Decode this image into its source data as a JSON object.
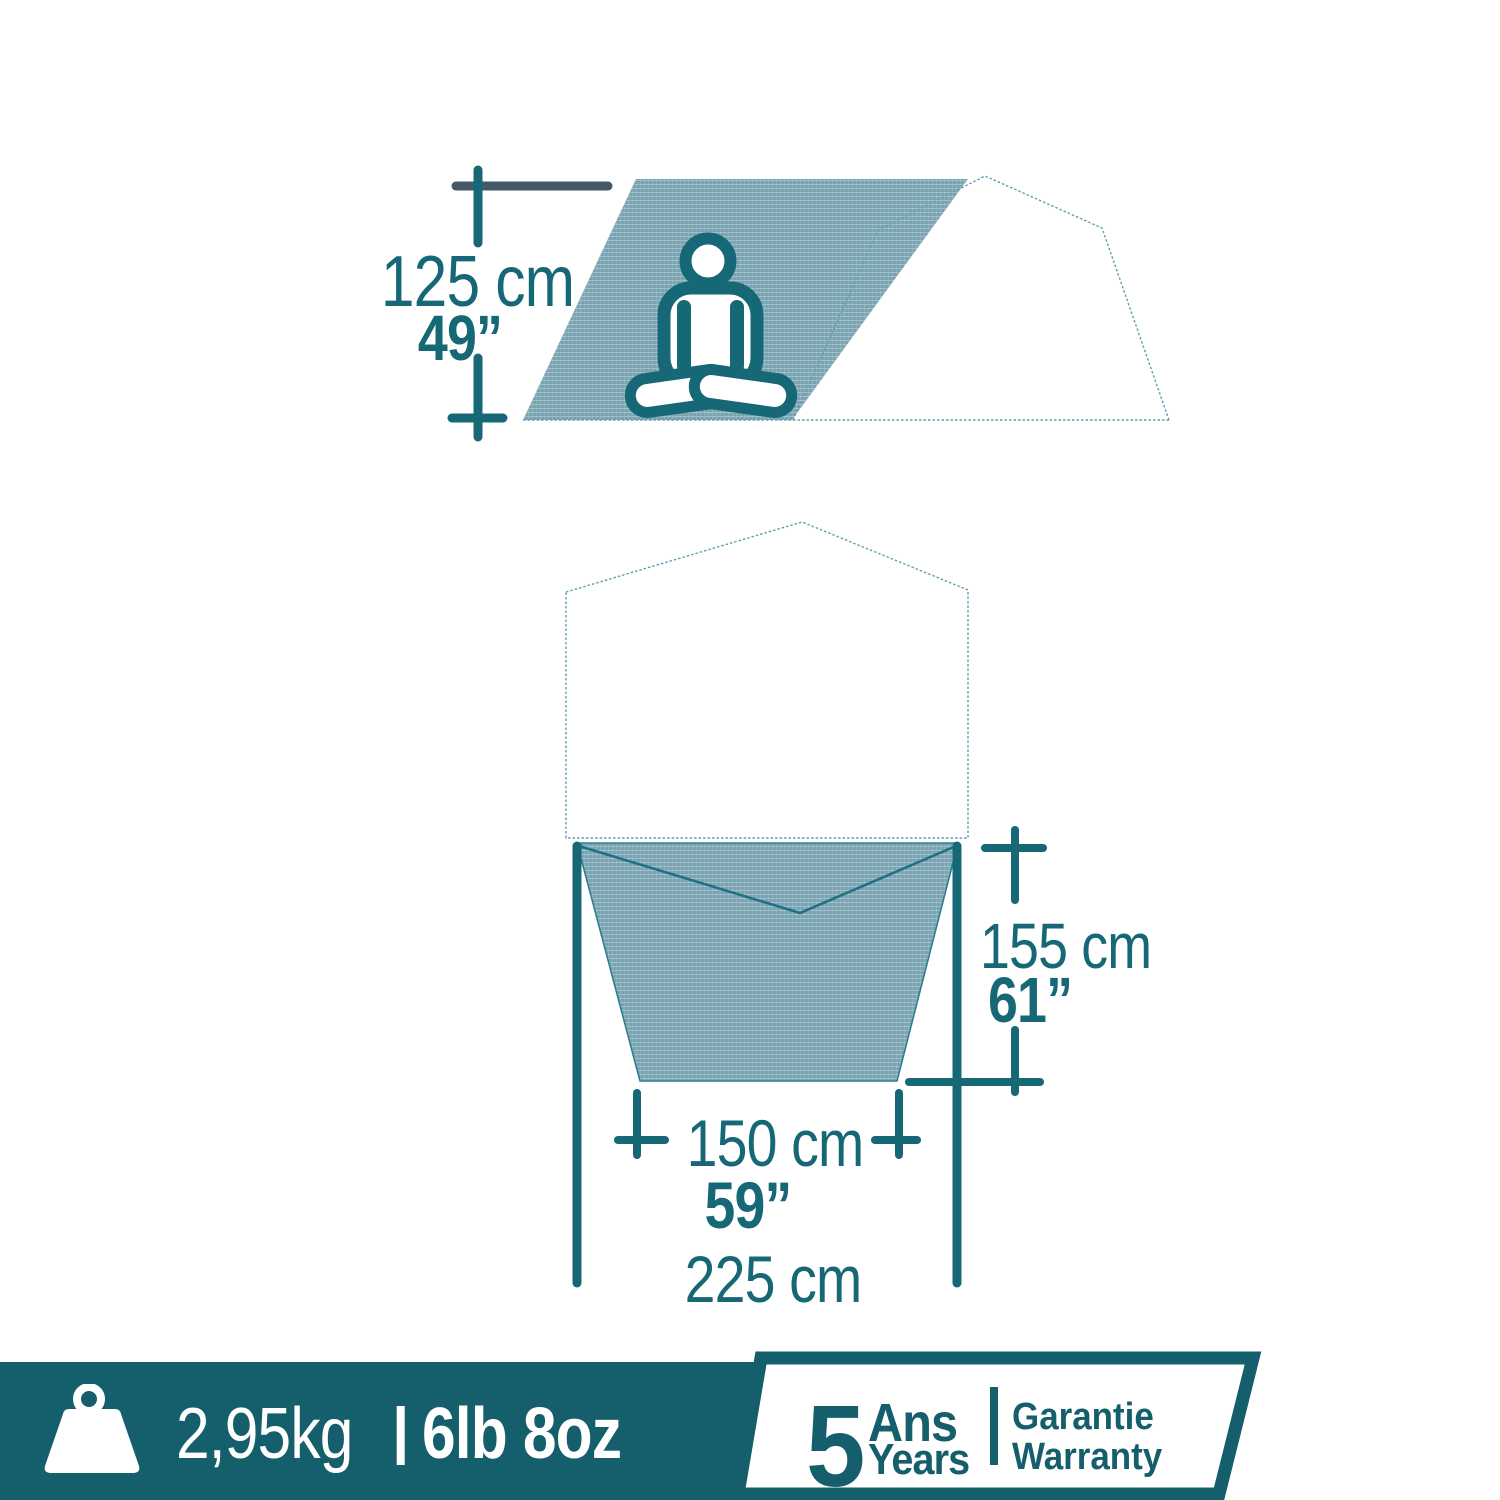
{
  "side_view": {
    "height_cm": "125 cm",
    "height_in": "49”"
  },
  "top_view": {
    "depth_cm": "155 cm",
    "depth_in": "61”",
    "inner_width_cm": "150 cm",
    "inner_width_in": "59”",
    "outer_width_cm": "225 cm"
  },
  "footer": {
    "weight_metric": "2,95kg",
    "separator": "|",
    "weight_imperial": "6lb 8oz"
  },
  "warranty_badge": {
    "number": "5",
    "unit_fr": "Ans",
    "unit_en": "Years",
    "label_fr": "Garantie",
    "label_en": "Warranty"
  },
  "icons": {
    "person": "person-meditating-icon",
    "weight": "weight-icon"
  },
  "colors": {
    "teal_text": "#166876",
    "dark_teal": "#145F6B",
    "slate_gray": "#445866",
    "fabric_fill": "#7AA4B2",
    "outline_teal": "#5FA0B0",
    "background": "#FFFFFF"
  }
}
